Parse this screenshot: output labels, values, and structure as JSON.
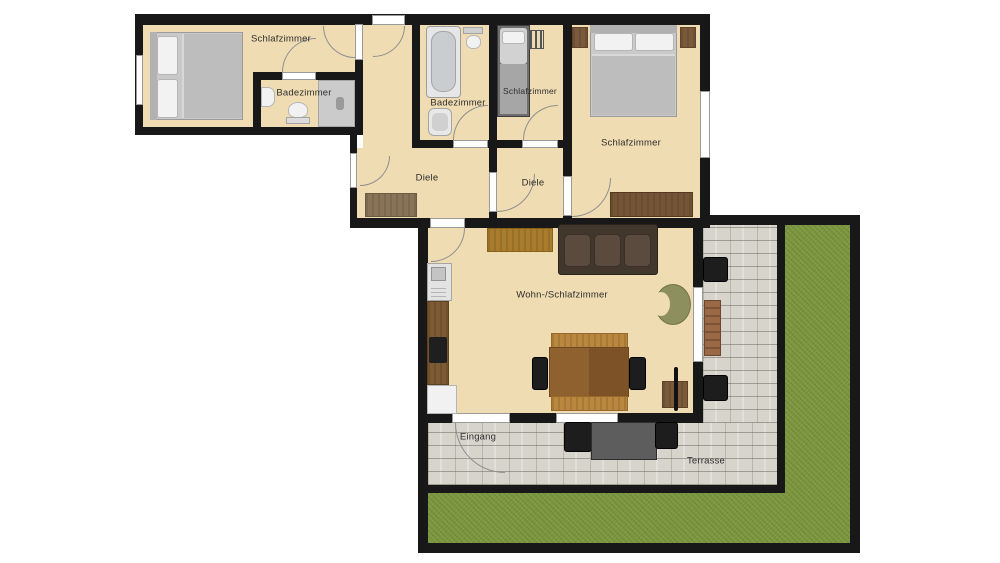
{
  "labels": {
    "bedroom_left": "Schlafzimmer",
    "bathroom_left": "Badezimmer",
    "bathroom_mid": "Badezimmer",
    "bedroom_small": "Schlafzimmer",
    "bedroom_right": "Schlafzimmer",
    "hall_left": "Diele",
    "hall_right": "Diele",
    "living_room": "Wohn-/Schlafzimmer",
    "entrance": "Eingang",
    "terrace": "Terrasse"
  },
  "colors": {
    "wall": "#181818",
    "floor": "#f0dcb2",
    "shower": "#cbcbcb",
    "terrace": "#d6d4cb",
    "lawn": "#7d983f",
    "window": "#ffffff",
    "label": "#2e2e2e",
    "sofa": "#42372d",
    "chair-green": "#8d905e",
    "wood-dark": "#76573a",
    "wood-mid": "#8b5e2e",
    "wood-light": "#b9873e"
  }
}
